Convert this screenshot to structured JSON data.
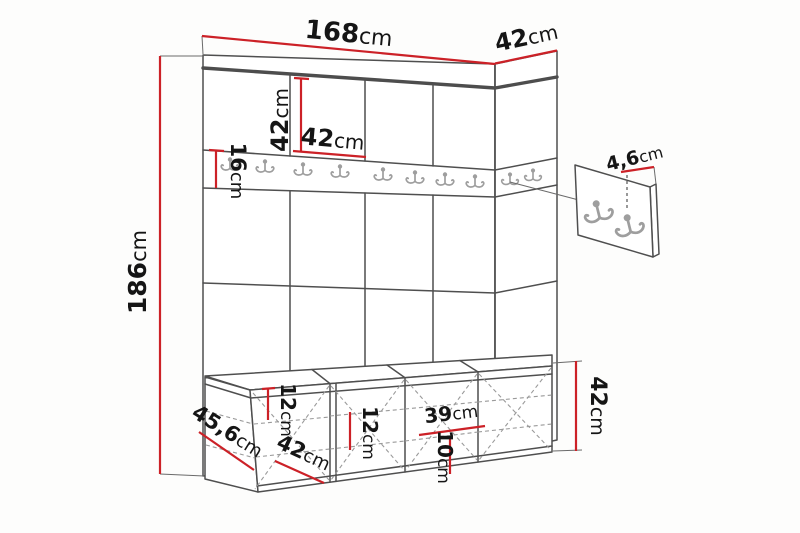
{
  "diagram": {
    "title": "Hallway furniture set dimension diagram",
    "colors": {
      "dimension_red": "#cc2127",
      "line_dark": "#4f4f4f",
      "hook_gray": "#9e9e9e"
    }
  },
  "dims": {
    "total_width": {
      "value": "168",
      "unit": "cm"
    },
    "side_panel_width": {
      "value": "42",
      "unit": "cm"
    },
    "total_height": {
      "value": "186",
      "unit": "cm"
    },
    "panel_tile_height": {
      "value": "42",
      "unit": "cm"
    },
    "panel_tile_width": {
      "value": "42",
      "unit": "cm"
    },
    "hook_rail_height": {
      "value": "16",
      "unit": "cm"
    },
    "hook_panel_thickness": {
      "value": "4,6",
      "unit": "cm"
    },
    "bench_depth": {
      "value": "45,6",
      "unit": "cm"
    },
    "bench_section_width": {
      "value": "42",
      "unit": "cm"
    },
    "bench_shelf_spacing_1": {
      "value": "12",
      "unit": "cm"
    },
    "bench_shelf_spacing_2": {
      "value": "12",
      "unit": "cm"
    },
    "bench_inner_width": {
      "value": "39",
      "unit": "cm"
    },
    "bench_bottom_clearance": {
      "value": "10",
      "unit": "cm"
    },
    "bench_height": {
      "value": "42",
      "unit": "cm"
    }
  }
}
